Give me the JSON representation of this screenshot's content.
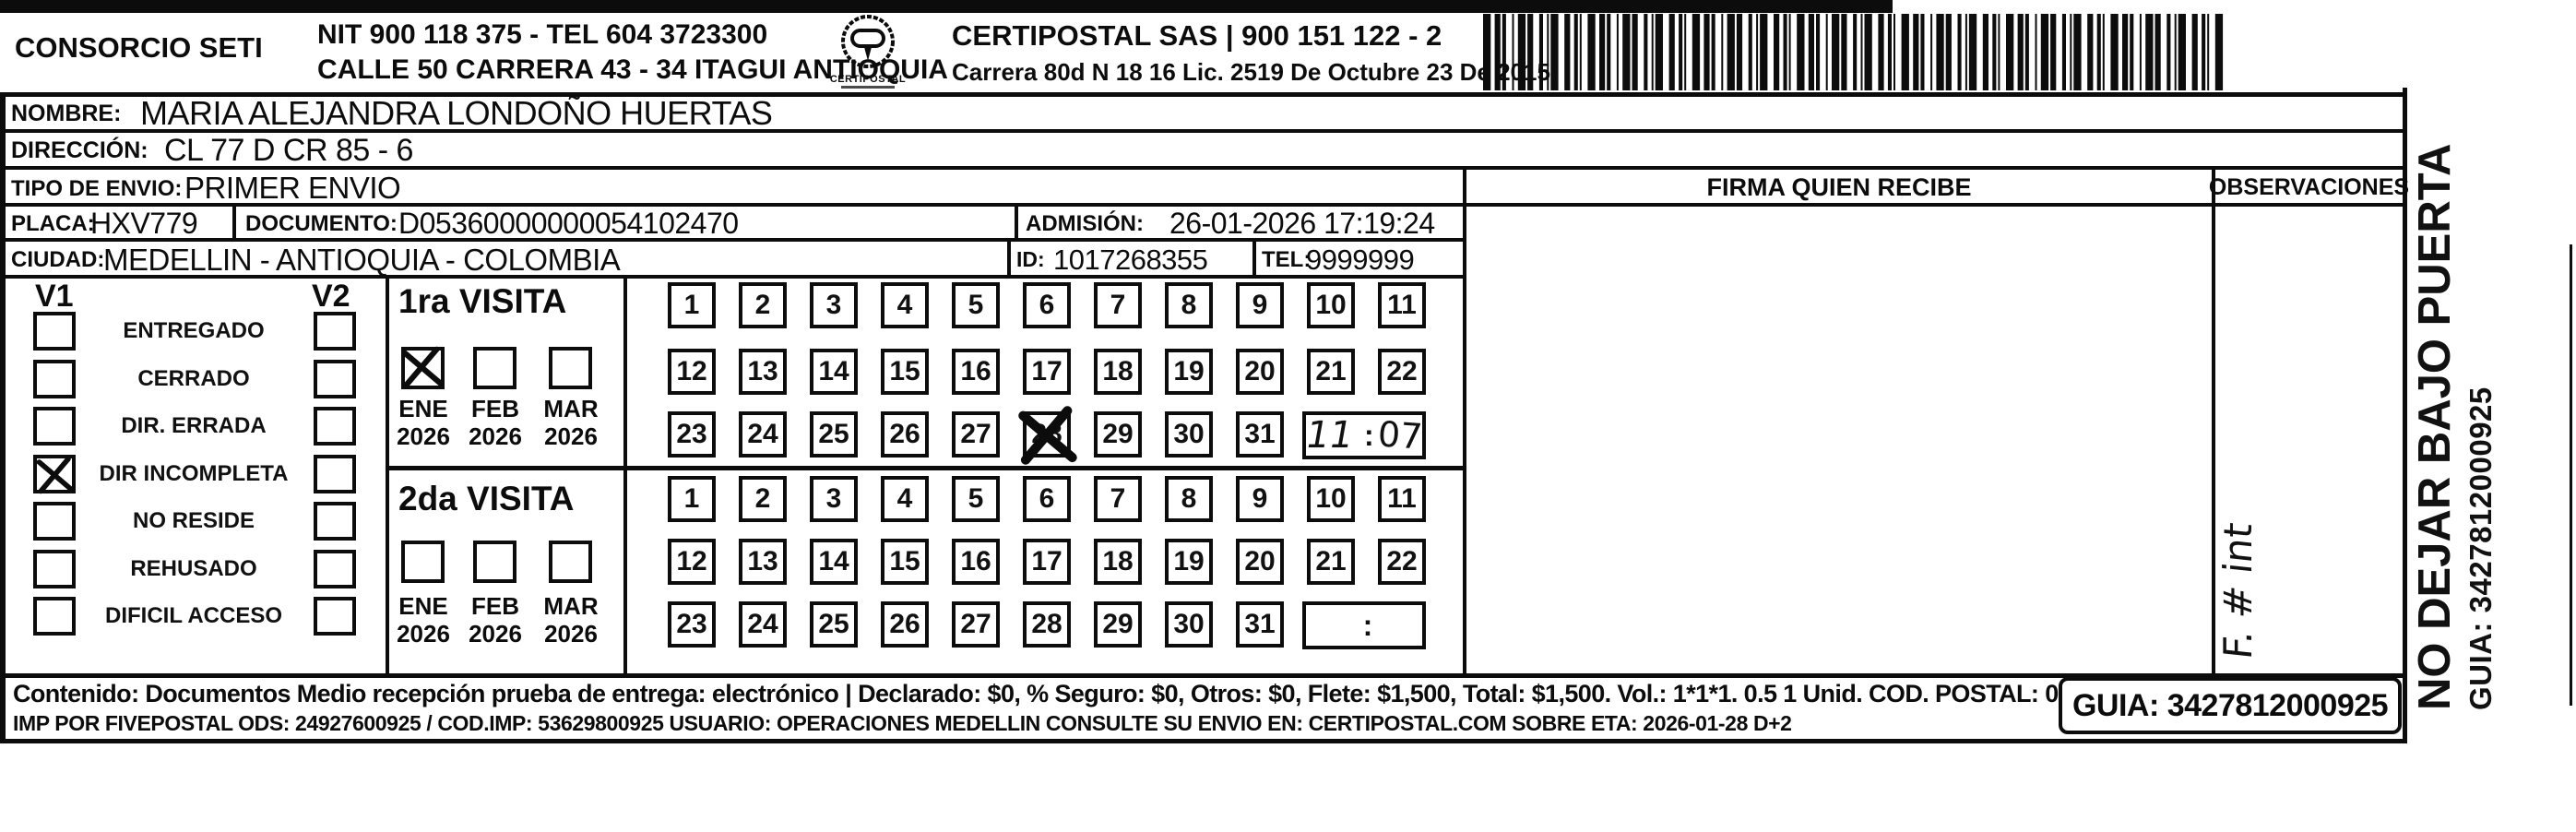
{
  "header": {
    "company": "CONSORCIO SETI",
    "nit_tel": "NIT 900 118 375 - TEL 604 3723300",
    "address": "CALLE 50 CARRERA 43 - 34 ITAGUI ANTIOQUIA",
    "logo_text": "CERTIPOSTAL",
    "operator": "CERTIPOSTAL SAS | 900 151 122 - 2",
    "license": "Carrera 80d N 18 16  Lic. 2519 De Octubre 23 De 2015"
  },
  "shipment": {
    "nombre_label": "NOMBRE:",
    "nombre": "MARIA ALEJANDRA LONDOÑO HUERTAS",
    "direccion_label": "DIRECCIÓN:",
    "direccion": "CL 77 D CR 85 - 6",
    "tipo_envio_label": "TIPO DE ENVIO:",
    "tipo_envio": "PRIMER ENVIO",
    "placa_label": "PLACA:",
    "placa": "HXV779",
    "documento_label": "DOCUMENTO:",
    "documento": "D05360000000054102470",
    "admision_label": "ADMISIÓN:",
    "admision": "26-01-2026 17:19:24",
    "ciudad_label": "CIUDAD:",
    "ciudad": "MEDELLIN - ANTIOQUIA - COLOMBIA",
    "id_label": "ID:",
    "id_value": "1017268355",
    "tel_label": "TEL:",
    "tel_value": "9999999"
  },
  "status_panel": {
    "v1": "V1",
    "v2": "V2",
    "options": [
      {
        "label": "ENTREGADO",
        "v1_checked": false,
        "v2_checked": false
      },
      {
        "label": "CERRADO",
        "v1_checked": false,
        "v2_checked": false
      },
      {
        "label": "DIR. ERRADA",
        "v1_checked": false,
        "v2_checked": false
      },
      {
        "label": "DIR INCOMPLETA",
        "v1_checked": true,
        "v2_checked": false
      },
      {
        "label": "NO RESIDE",
        "v1_checked": false,
        "v2_checked": false
      },
      {
        "label": "REHUSADO",
        "v1_checked": false,
        "v2_checked": false
      },
      {
        "label": "DIFICIL ACCESO",
        "v1_checked": false,
        "v2_checked": false
      }
    ]
  },
  "visits": {
    "days": [
      1,
      2,
      3,
      4,
      5,
      6,
      7,
      8,
      9,
      10,
      11,
      12,
      13,
      14,
      15,
      16,
      17,
      18,
      19,
      20,
      21,
      22,
      23,
      24,
      25,
      26,
      27,
      28,
      29,
      30,
      31
    ],
    "first": {
      "title": "1ra VISITA",
      "months": [
        {
          "name": "ENE",
          "year": "2026",
          "checked": true
        },
        {
          "name": "FEB",
          "year": "2026",
          "checked": false
        },
        {
          "name": "MAR",
          "year": "2026",
          "checked": false
        }
      ],
      "crossed_day": 28,
      "time_hour": "11",
      "time_separator": ":",
      "time_minute": "07"
    },
    "second": {
      "title": "2da VISITA",
      "months": [
        {
          "name": "ENE",
          "year": "2026",
          "checked": false
        },
        {
          "name": "FEB",
          "year": "2026",
          "checked": false
        },
        {
          "name": "MAR",
          "year": "2026",
          "checked": false
        }
      ],
      "crossed_day": null,
      "time_hour": "",
      "time_separator": ":",
      "time_minute": ""
    }
  },
  "signature_section": {
    "firma_label": "FIRMA QUIEN RECIBE",
    "observaciones_label": "OBSERVACIONES",
    "observaciones_note": "F. # int"
  },
  "side_text": {
    "line1": "NO DEJAR BAJO PUERTA",
    "line2": "GUIA: 3427812000925"
  },
  "footer": {
    "line1": "Contenido: Documentos Medio recepción prueba de entrega: electrónico | Declarado: $0, % Seguro: $0, Otros: $0, Flete: $1,500, Total: $1,500. Vol.: 1*1*1. 0.5  1 Unid. COD. POSTAL: 050041",
    "line2": "IMP POR FIVEPOSTAL ODS: 24927600925 / COD.IMP: 53629800925 USUARIO: OPERACIONES MEDELLIN CONSULTE SU ENVIO EN: CERTIPOSTAL.COM SOBRE ETA: 2026-01-28 D+2",
    "guia": "GUIA: 3427812000925"
  },
  "colors": {
    "ink": "#0c0c0c",
    "paper": "#ffffff"
  }
}
